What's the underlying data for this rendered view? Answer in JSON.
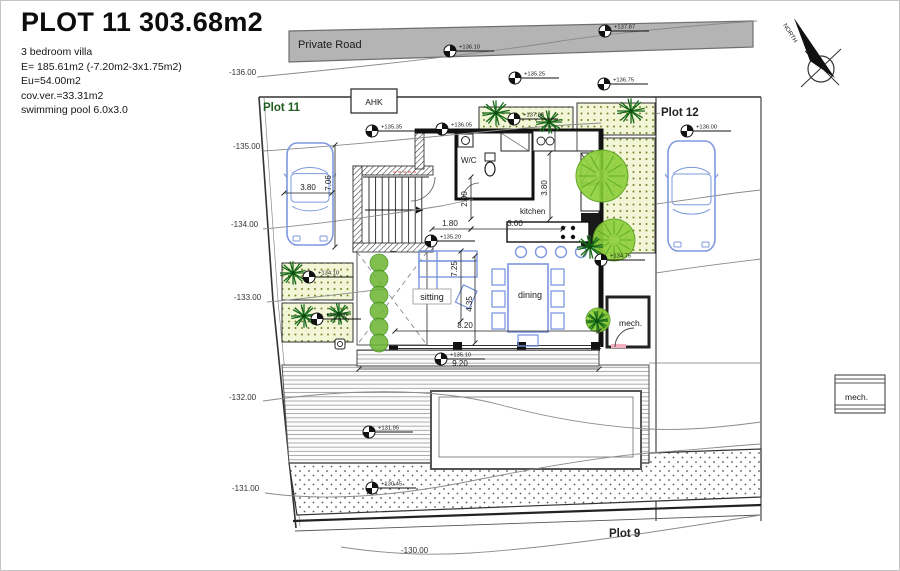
{
  "title_block": {
    "title": "PLOT 11 303.68m2",
    "notes": [
      "3 bedroom villa",
      "E= 185.61m2 (-7.20m2-3x1.75m2)",
      "Eu=54.00m2",
      "cov.ver.=33.31m2",
      "swimming pool 6.0x3.0"
    ]
  },
  "road": {
    "label": "Private Road",
    "x": 297,
    "y": 47
  },
  "plot_labels": [
    {
      "text": "Plot 11",
      "x": 262,
      "y": 110,
      "color": "#1e5c1e"
    },
    {
      "text": "Plot 12",
      "x": 660,
      "y": 115,
      "color": "#222222"
    },
    {
      "text": "Plot 9",
      "x": 608,
      "y": 536,
      "color": "#222222"
    }
  ],
  "room_labels": [
    {
      "text": "AHK",
      "x": 373,
      "y": 104,
      "size": 8.5,
      "anchor": "middle"
    },
    {
      "text": "W/C",
      "x": 460,
      "y": 162,
      "size": 8,
      "anchor": "start"
    },
    {
      "text": "kitchen",
      "x": 519,
      "y": 213,
      "size": 8,
      "anchor": "start"
    },
    {
      "text": "sitting",
      "x": 431,
      "y": 299,
      "size": 9,
      "anchor": "middle"
    },
    {
      "text": "dining",
      "x": 517,
      "y": 297,
      "size": 9,
      "anchor": "start"
    },
    {
      "text": "mech.",
      "x": 618,
      "y": 325,
      "size": 8.5,
      "anchor": "start"
    },
    {
      "text": "mech.",
      "x": 844,
      "y": 399,
      "size": 8.5,
      "anchor": "start"
    }
  ],
  "contour_labels": [
    {
      "text": "-136.00",
      "x": 228,
      "y": 74
    },
    {
      "text": "-135.00",
      "x": 232,
      "y": 148
    },
    {
      "text": "-134.00",
      "x": 230,
      "y": 226
    },
    {
      "text": "-133.00",
      "x": 233,
      "y": 299
    },
    {
      "text": "-132.00",
      "x": 228,
      "y": 399
    },
    {
      "text": "-131.00",
      "x": 231,
      "y": 490
    },
    {
      "text": "-130.00",
      "x": 400,
      "y": 552
    }
  ],
  "spot_levels": [
    {
      "text": "+136.10",
      "x": 449,
      "y": 50
    },
    {
      "text": "+135.25",
      "x": 514,
      "y": 77
    },
    {
      "text": "+137.87",
      "x": 604,
      "y": 30
    },
    {
      "text": "+136.75",
      "x": 603,
      "y": 83
    },
    {
      "text": "+135.35",
      "x": 371,
      "y": 130
    },
    {
      "text": "+136.05",
      "x": 441,
      "y": 128
    },
    {
      "text": "+137.85",
      "x": 513,
      "y": 118
    },
    {
      "text": "+136.00",
      "x": 686,
      "y": 130
    },
    {
      "text": "+135.20",
      "x": 430,
      "y": 240
    },
    {
      "text": "+134.75",
      "x": 600,
      "y": 259
    },
    {
      "text": "+134.10",
      "x": 308,
      "y": 276
    },
    {
      "text": "+133.60",
      "x": 316,
      "y": 318
    },
    {
      "text": "+135.10",
      "x": 440,
      "y": 358
    },
    {
      "text": "+131.95",
      "x": 368,
      "y": 431
    },
    {
      "text": "+130.45",
      "x": 371,
      "y": 487
    }
  ],
  "dimensions": [
    {
      "text": "3.80",
      "x": 307,
      "y": 189,
      "rot": 0
    },
    {
      "text": "7.06",
      "x": 330,
      "y": 182,
      "rot": -90
    },
    {
      "text": "2.00",
      "x": 466,
      "y": 198,
      "rot": -90
    },
    {
      "text": "1.80",
      "x": 449,
      "y": 225,
      "rot": 0
    },
    {
      "text": "3.00",
      "x": 514,
      "y": 225,
      "rot": 0
    },
    {
      "text": "3.80",
      "x": 546,
      "y": 187,
      "rot": -90
    },
    {
      "text": "7.25",
      "x": 456,
      "y": 268,
      "rot": -90
    },
    {
      "text": "4.35",
      "x": 471,
      "y": 303,
      "rot": -90
    },
    {
      "text": "8.20",
      "x": 464,
      "y": 327,
      "rot": 0
    },
    {
      "text": "9.20",
      "x": 459,
      "y": 365,
      "rot": 0
    }
  ],
  "compass": {
    "label": "NORTH"
  },
  "colors": {
    "furniture": "#7d98dd",
    "tree_dark": "#17691a",
    "canopy": "#8fd03c",
    "road_fill": "#b4b4b4",
    "bed_fill": "#f3f6d6",
    "wall": "#111111",
    "contour": "#8a8a8a",
    "accent_red": "#e06060"
  }
}
